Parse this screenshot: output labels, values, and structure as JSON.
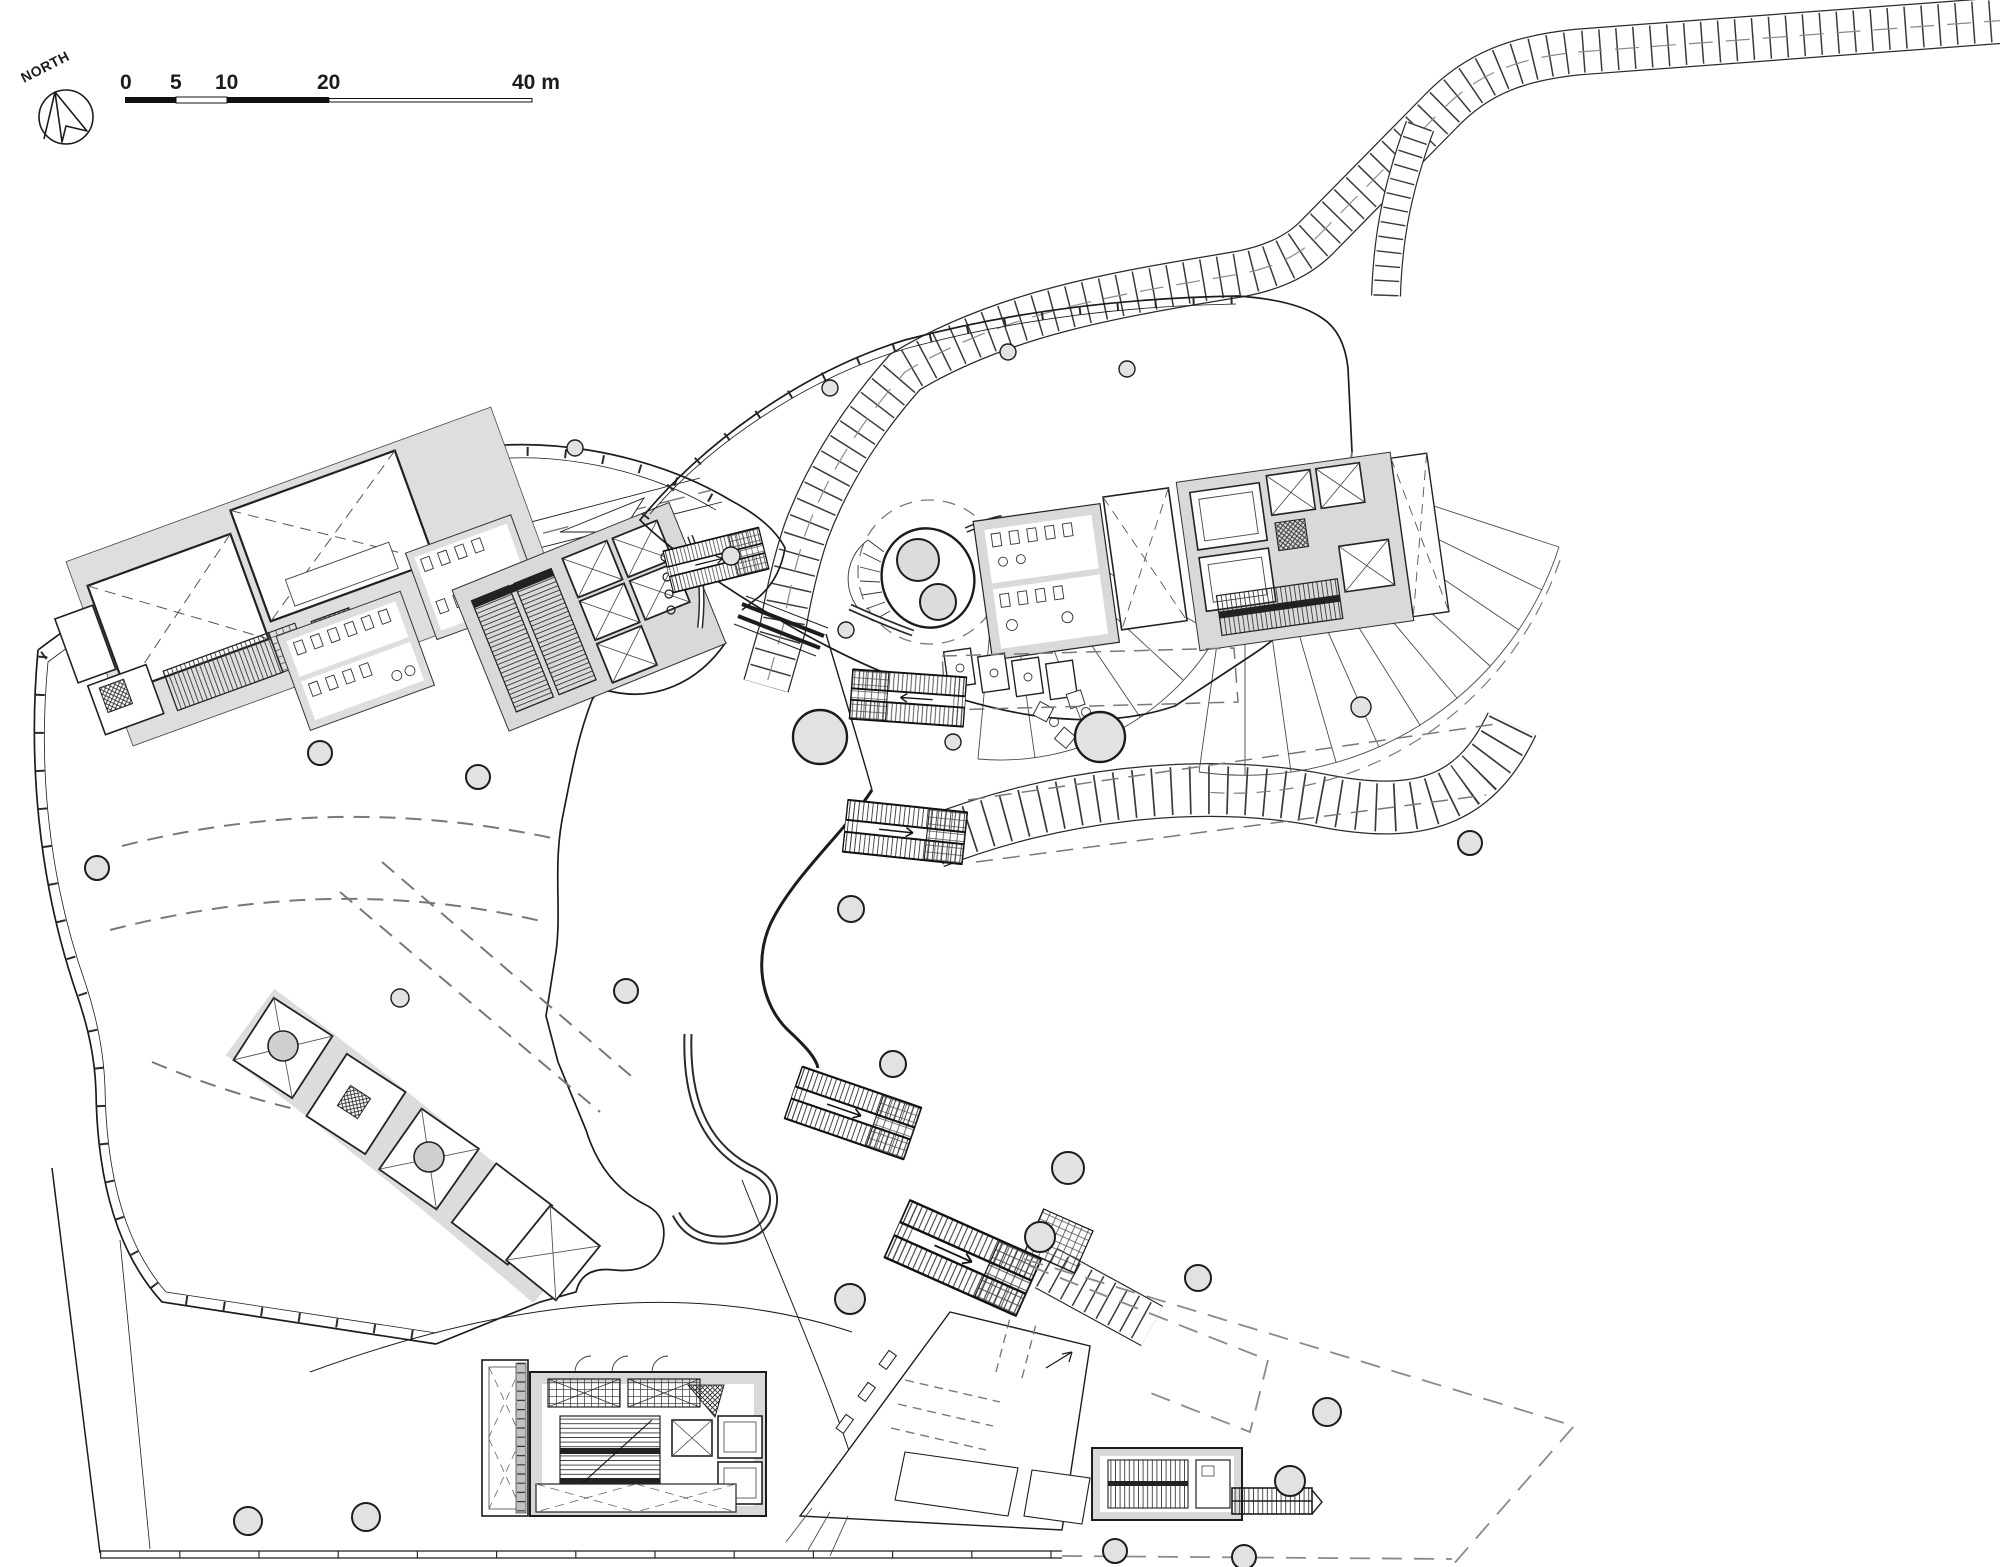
{
  "drawing": {
    "kind": "architectural-floor-plan",
    "compass": {
      "label": "NORTH"
    },
    "scale_bar": {
      "labels": [
        "0",
        "5",
        "10",
        "20",
        "40 m"
      ],
      "unit": "m"
    },
    "colors": {
      "paper": "#ffffff",
      "ink": "#1c1c1c",
      "wall_gray": "#d8d8d8",
      "dark_gray": "#9e9e9e",
      "column_fill": "#e2e2e2",
      "dash_gray": "#787878"
    },
    "features": {
      "left_building": "curved office wing with cores, toilets and lift lobby",
      "right_building": "curved pavilion with toilets, lift core and spiral stair",
      "bottom_core": "basement core with escalators and lifts",
      "entrance_hall": "tilted entrance hall with queue lines",
      "stair_annex": "small stair annex",
      "walkways": "stepped promenade bands looping the plaza",
      "escalators": "five escalator banks crossing the plaza",
      "columns": "round structural columns",
      "overlays": "dashed outlines of elements above"
    }
  }
}
